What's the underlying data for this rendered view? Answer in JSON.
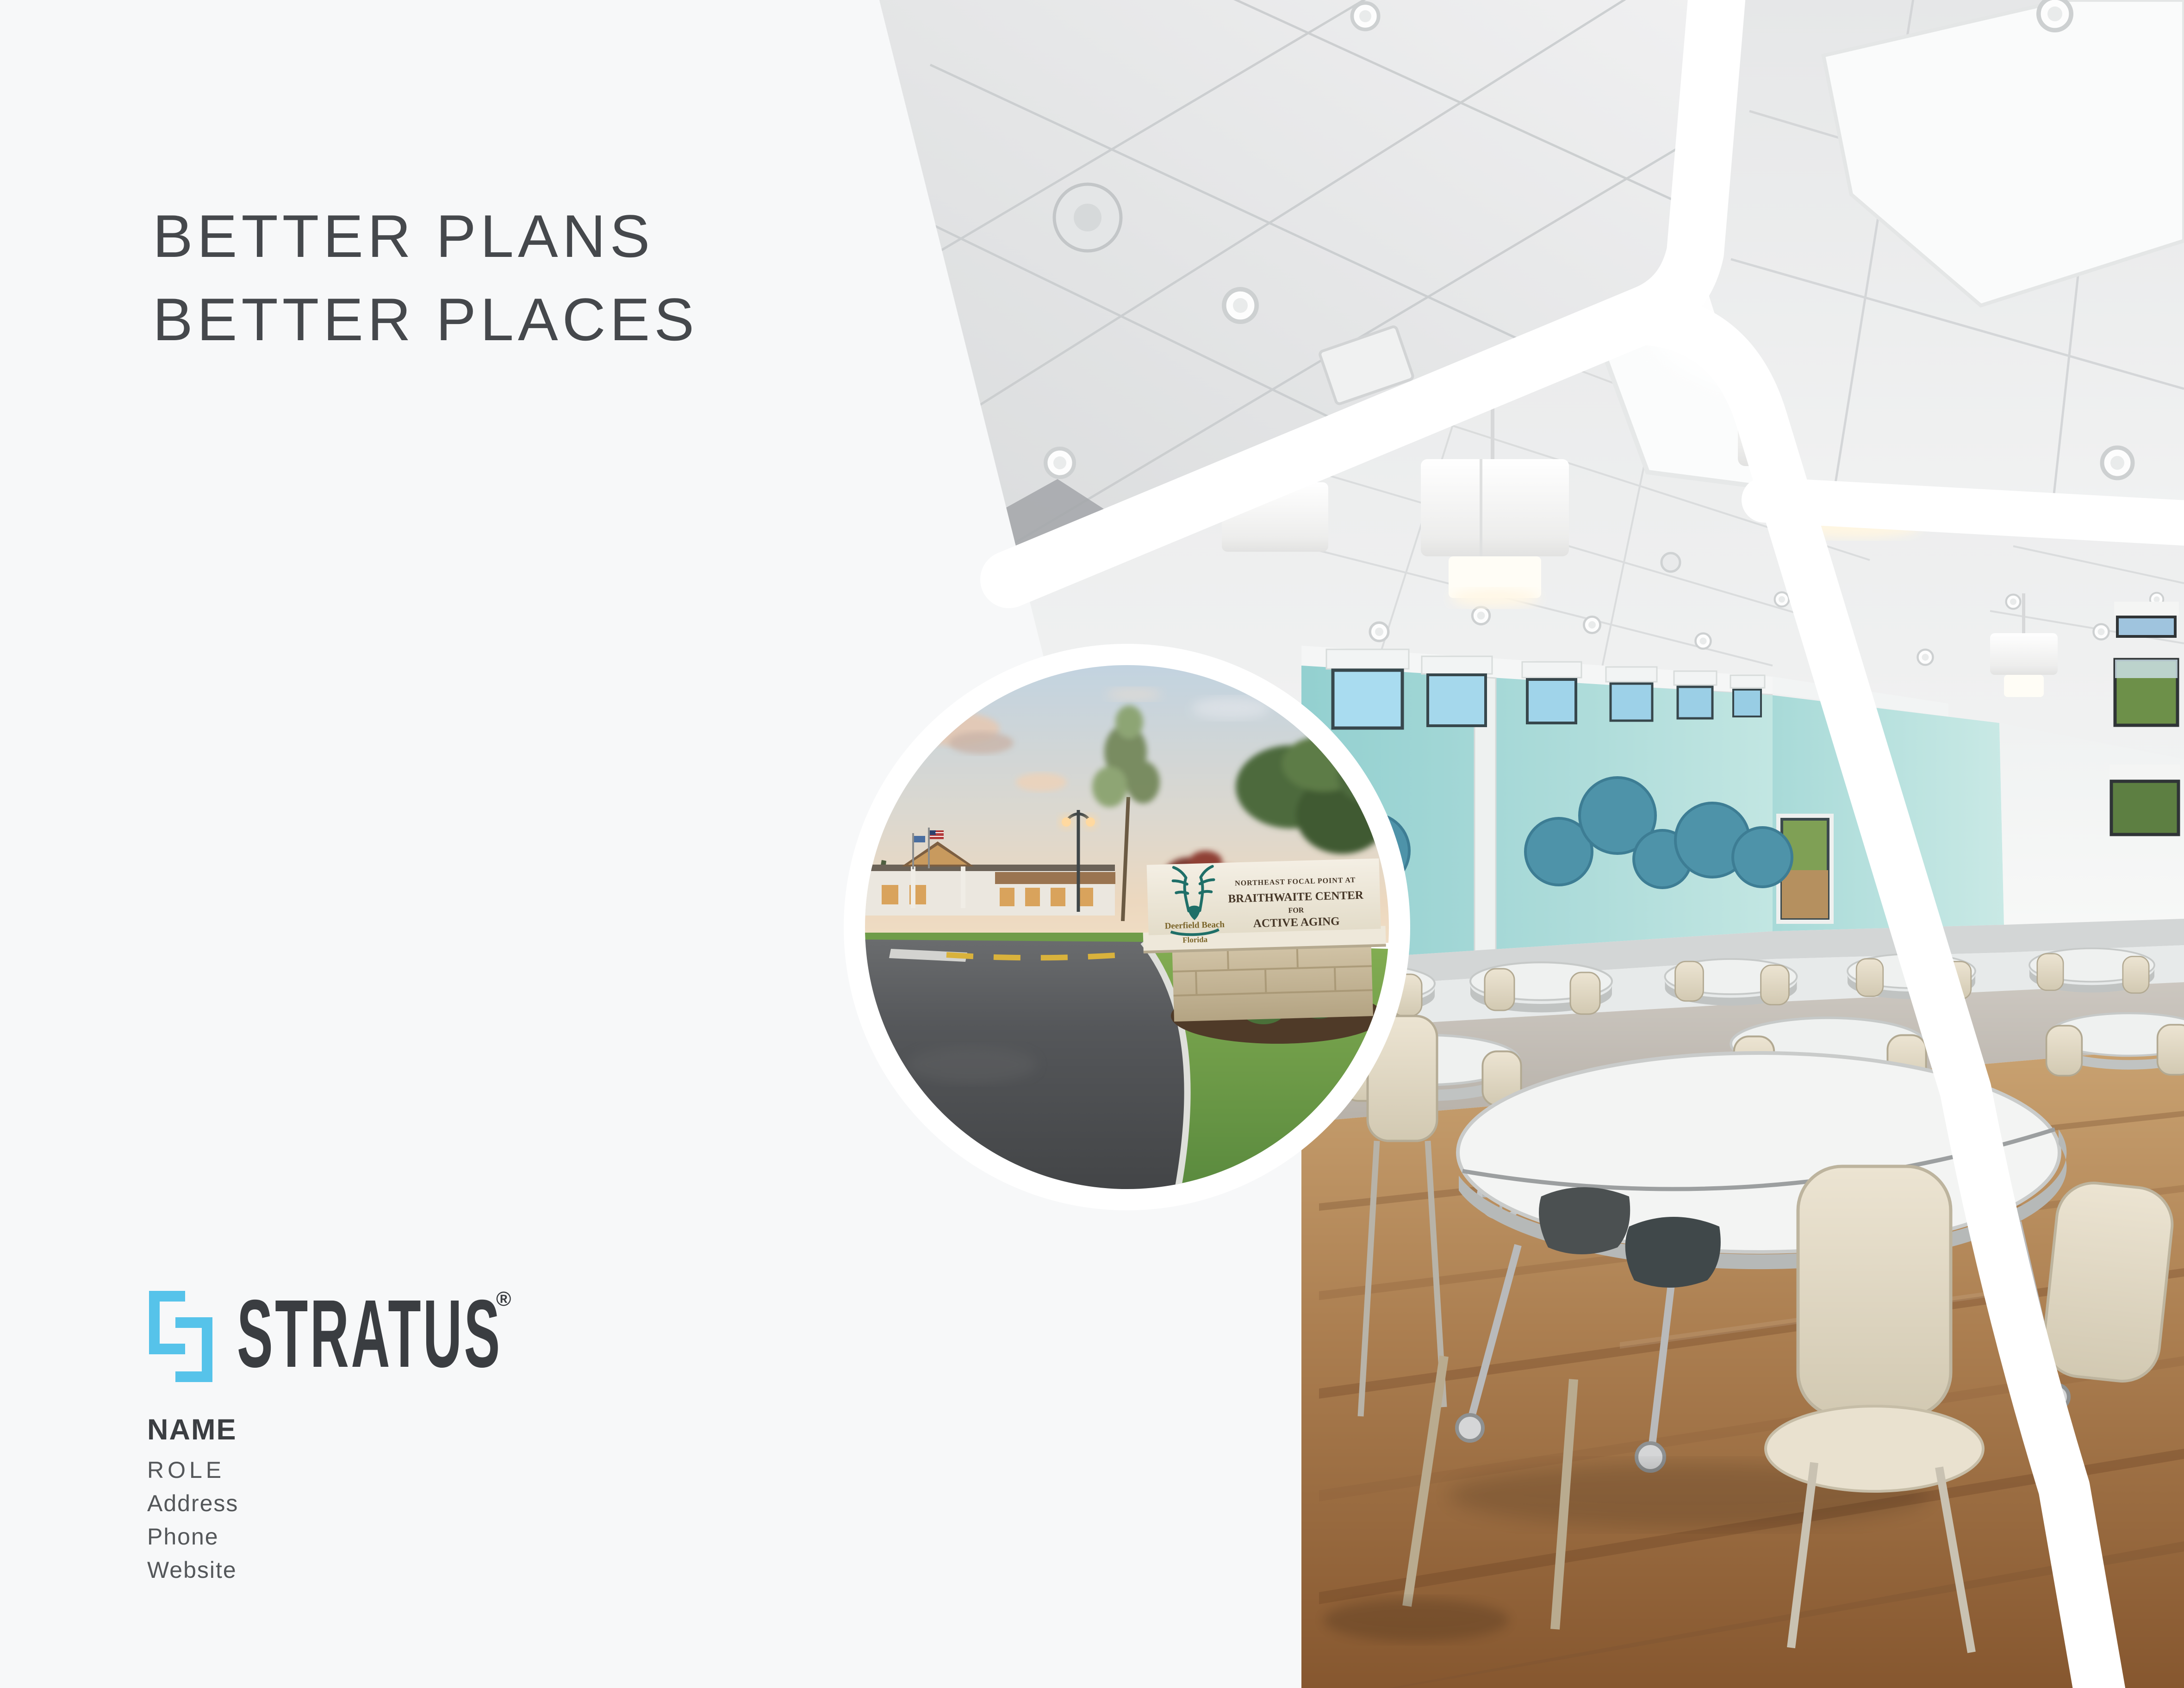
{
  "page": {
    "background": "#f7f8f9",
    "band_color": "#ffffff"
  },
  "headline": {
    "line1": "BETTER PLANS",
    "line2": "BETTER PLACES",
    "color": "#45484c"
  },
  "logo": {
    "brand": "STRATUS",
    "registered_mark": "®",
    "icon": "interlocking-brackets-icon",
    "accent_color": "#56c3ea",
    "text_color": "#3a3d41"
  },
  "contact": {
    "name": "NAME",
    "role": "ROLE",
    "address": "Address",
    "phone": "Phone",
    "website": "Website"
  },
  "inset_photo": {
    "description": "exterior entrance drive at dusk with monument sign",
    "sign": {
      "line1": "NORTHEAST FOCAL POINT AT",
      "line2": "BRAITHWAITE CENTER",
      "line3": "FOR",
      "line4": "ACTIVE AGING",
      "municipality": "Deerfield Beach",
      "state": "Florida",
      "text_color": "#453627",
      "municipal_logo_color": "#1f6f68",
      "municipality_text_color": "#7a6428"
    }
  },
  "main_photo": {
    "description": "senior center dining hall interior",
    "wall_color": "#9fd6d5",
    "accent_circle_color": "#4e93a9",
    "floor_wood_color": "#a97c4e",
    "chair_color": "#ddd4c0"
  }
}
